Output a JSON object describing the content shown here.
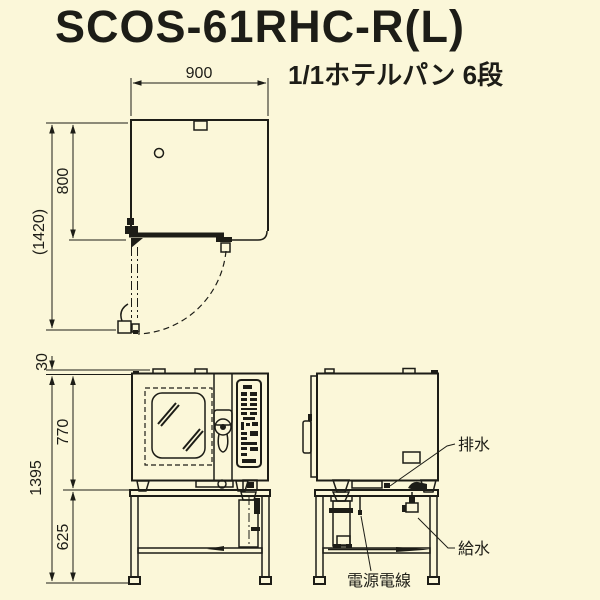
{
  "title": "SCOS-61RHC-R(L)",
  "subtitle": "1/1ホテルパン 6段",
  "colors": {
    "background": "#FBF7D9",
    "line": "#1D1D17"
  },
  "top_view": {
    "width_mm": "900",
    "depth_mm": "800",
    "depth_door_open_mm": "(1420)"
  },
  "front_view": {
    "top_tab_mm": "30",
    "body_height_mm": "770",
    "overall_height_mm": "1395",
    "stand_height_mm": "625"
  },
  "side_view": {
    "drain_label": "排水",
    "water_supply_label": "給水",
    "power_cable_label": "電源電線"
  }
}
